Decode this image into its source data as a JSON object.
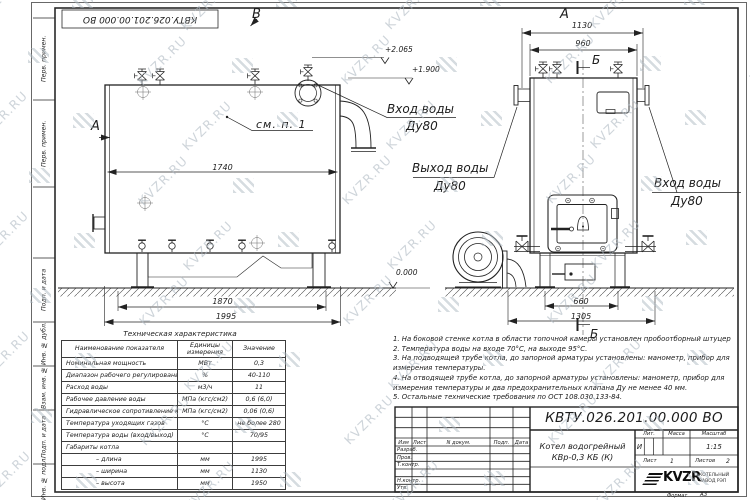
{
  "watermark": {
    "text": "KVZR.RU"
  },
  "sheet": {
    "top_stamp": "КВТУ.026.201.00.000  ВО",
    "format_word": "Формат",
    "format_value": "А3"
  },
  "margin": {
    "labels": [
      "Перв. примен.",
      "Перв. примен.",
      "Подп. и дата",
      "Инв. № дубл.",
      "Взам. инв. №",
      "Подп. и дата",
      "Инв. № подл."
    ]
  },
  "views": {
    "label_v": "В",
    "label_a": "А",
    "label_b_section": "Б",
    "note_ref": "см. п. 1",
    "inlet_label": "Вход воды",
    "outlet_label": "Выход воды",
    "dn": "Ду80",
    "elev_top": "+2.065",
    "elev_mid": "+1.900",
    "elev_zero": "0.000",
    "dim_1740": "1740",
    "dim_1870": "1870",
    "dim_1995": "1995",
    "dim_1130": "1130",
    "dim_960": "960",
    "dim_660": "660",
    "dim_1305": "1305"
  },
  "table": {
    "title": "Техническая характеристика",
    "col_headers": [
      "Наименование показателя",
      "Единицы измерения",
      "Значение"
    ],
    "rows": [
      [
        "Номинальная мощность",
        "МВт",
        "0,3"
      ],
      [
        "Диапазон рабочего регулирования",
        "%",
        "40-110"
      ],
      [
        "Расход воды",
        "м3/ч",
        "11"
      ],
      [
        "Рабочее давление воды",
        "МПа (кгс/см2)",
        "0,6 (6,0)"
      ],
      [
        "Гидравлическое сопротивление котла",
        "МПа (кгс/см2)",
        "0,06 (0,6)"
      ],
      [
        "Температура уходящих газов",
        "°С",
        "не более 280"
      ],
      [
        "Температура воды (вход/выход)",
        "°С",
        "70/95"
      ],
      [
        "Габариты котла",
        "",
        ""
      ],
      [
        "– длина",
        "мм",
        "1995"
      ],
      [
        "– ширина",
        "мм",
        "1130"
      ],
      [
        "– высота",
        "мм",
        "1950"
      ]
    ]
  },
  "notes": {
    "lines": [
      "1.  На боковой стенке котла в области топочной камеры установлен пробоотборный штуцер",
      "2.  Температура воды на входе  70°С,  на выходе  95°С.",
      "3.  На подводящей трубе котла, до запорной арматуры установлены:  манометр,  прибор для",
      "измерения температуры.",
      "4.  На отводящей трубе котла, до запорной арматуры установлены:  манометр,  прибор для",
      "измерения температуры и два предохранительных клапана  Ду не менее  40 мм.",
      "5.  Остальные технические требования по ОСТ  108.030.133-84."
    ]
  },
  "title_block": {
    "designation": "КВТУ.026.201.00.000  ВО",
    "header_cells": [
      "Изм",
      "Лист",
      "N докум.",
      "Подп.",
      "Дата"
    ],
    "row_labels": [
      "Разраб.",
      "Пров.",
      "Т.контр.",
      "Н.контр.",
      "Утв."
    ],
    "doc_name_line1": "Котел водогрейный",
    "doc_name_line2": "КВр-0,3  КБ  (К)",
    "lit_header": "Лит.",
    "mass_header": "Масса",
    "scale_header": "Масштаб",
    "lit_value": "И",
    "scale_value": "1:15",
    "sheet_label": "Лист",
    "sheet_value": "1",
    "sheets_label": "Листов",
    "sheets_value": "2",
    "company_logo_text": "KVZR",
    "company_name_line1": "КОТЕЛЬНЫЙ",
    "company_name_line2": "ЗАВОД РЭП"
  }
}
